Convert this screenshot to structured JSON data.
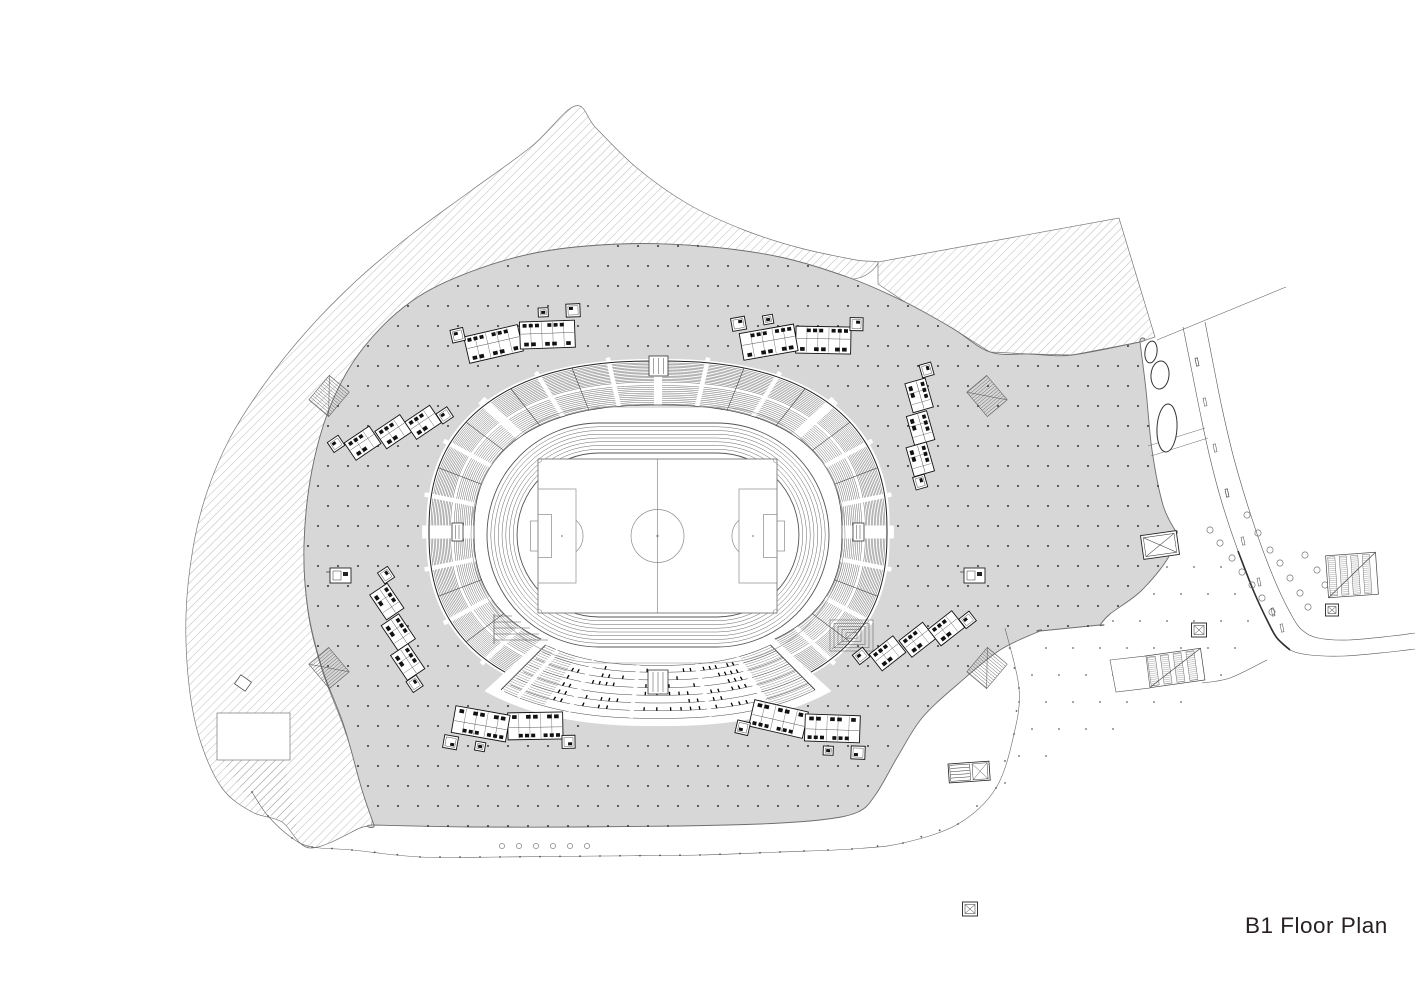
{
  "title": {
    "label": "B1 Floor Plan"
  },
  "palette": {
    "background": "#ffffff",
    "concourse_fill": "#d7d7d7",
    "hatch_line": "#808080",
    "line_dark": "#1c1c1c",
    "line_mid": "#555555",
    "line_soft": "#8c8c8c",
    "dot_color": "#3c3c3c",
    "field_line": "#8a8a8a",
    "title_color": "#272122"
  },
  "plan": {
    "drawing_label": "B1 Floor Plan",
    "level": "B1",
    "features": {
      "track_lanes": 9,
      "facility_clusters": 8,
      "service_kiosks": 2,
      "stair_ramps": 2,
      "field_type": "soccer-field-with-athletics-track",
      "regions": [
        "landscape-slope-hatch",
        "outer-concourse",
        "stadium-seating-bowl",
        "athletics-track",
        "soccer-field",
        "south-bleachers",
        "east-plaza",
        "access-road"
      ]
    }
  }
}
